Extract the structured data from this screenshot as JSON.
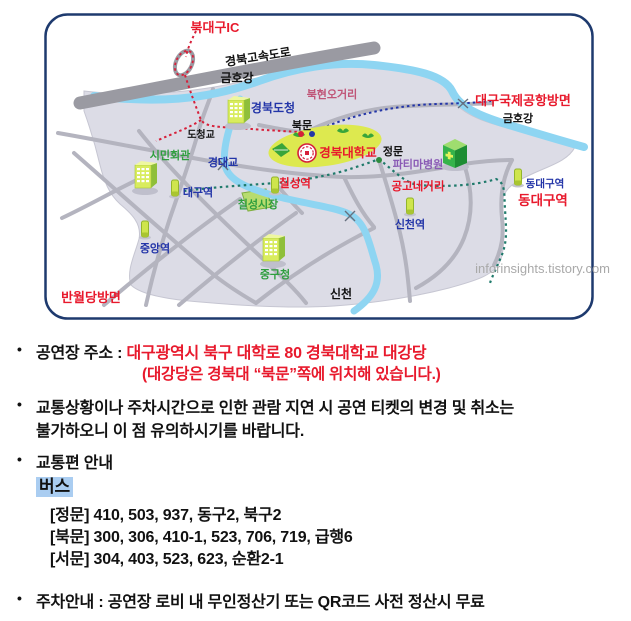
{
  "palette": {
    "red": "#e8192c",
    "navy": "#2335a8",
    "black": "#111111",
    "green": "#2e9e3e",
    "violet": "#8a5bb5",
    "rose": "#c05577",
    "gray_watermark": "#a9a9a9",
    "campus": "#dde94f",
    "river": "#8ed5f2",
    "land": "#dcdce6",
    "road": "#b4b4bf",
    "highway": "#9a9aa2",
    "subway_teal": "#1f7a6b",
    "bus_highlight": "#aacdf1",
    "map_border": "#1e3a6e"
  },
  "map": {
    "labels": [
      {
        "name": "bukdaegu-ic",
        "text": "북대구IC",
        "color": "#e8192c"
      },
      {
        "name": "gyeongbu-expressway",
        "text": "경북고속도로",
        "color": "#111111"
      },
      {
        "name": "geumhogang-west",
        "text": "금호강",
        "color": "#111111"
      },
      {
        "name": "gyeongbuk-docheong",
        "text": "경북도청",
        "color": "#2335a8"
      },
      {
        "name": "bukhyeon-ogeori",
        "text": "북현오거리",
        "color": "#c05577"
      },
      {
        "name": "airport-direction",
        "text": "대구국제공항방면",
        "color": "#e8192c"
      },
      {
        "name": "geumhogang-east",
        "text": "금호강",
        "color": "#111111"
      },
      {
        "name": "bukmun-gate",
        "text": "북문",
        "color": "#111111"
      },
      {
        "name": "docheonggyo-bridge",
        "text": "도청교",
        "color": "#111111"
      },
      {
        "name": "simin-hall",
        "text": "시민회관",
        "color": "#2e9e3e"
      },
      {
        "name": "gyeongdaegyo-bridge",
        "text": "경대교",
        "color": "#2335a8"
      },
      {
        "name": "knu-campus",
        "text": "경북대학교",
        "color": "#e8192c"
      },
      {
        "name": "jeongmun-gate",
        "text": "정문",
        "color": "#111111"
      },
      {
        "name": "fatima-hospital",
        "text": "파티마병원",
        "color": "#8a5bb5"
      },
      {
        "name": "gonggo-negeori",
        "text": "공고네거리",
        "color": "#e8192c"
      },
      {
        "name": "chilseong-station",
        "text": "칠성역",
        "color": "#e8192c"
      },
      {
        "name": "chilseong-market",
        "text": "칠성시장",
        "color": "#2e9e3e"
      },
      {
        "name": "daegu-station",
        "text": "대구역",
        "color": "#2335a8"
      },
      {
        "name": "jungang-station",
        "text": "중앙역",
        "color": "#2335a8"
      },
      {
        "name": "junggu-office",
        "text": "중구청",
        "color": "#2e9e3e"
      },
      {
        "name": "sincheon-station",
        "text": "신천역",
        "color": "#2335a8"
      },
      {
        "name": "dongdaegu-station-small",
        "text": "동대구역",
        "color": "#2335a8"
      },
      {
        "name": "dongdaegu-station-big",
        "text": "동대구역",
        "color": "#e8192c"
      },
      {
        "name": "banwoldang-direction",
        "text": "반월당방면",
        "color": "#e8192c"
      },
      {
        "name": "sincheon-river",
        "text": "신천",
        "color": "#111111"
      }
    ],
    "watermark": "inforinsights.tistory.com"
  },
  "info": {
    "bullet": "•",
    "address_label": "공연장 주소 : ",
    "address_value": "대구광역시 북구 대학로 80 경북대학교 대강당",
    "address_note": "(대강당은 경북대 “북문”쪽에 위치해 있습니다.)",
    "notice_line1": "교통상황이나 주차시간으로 인한 관람 지연 시 공연 티켓의 변경 및 취소는",
    "notice_line2": "불가하오니 이 점 유의하시기를 바랍니다.",
    "transport_title": "교통편 안내",
    "bus_label": "버스",
    "bus_routes": [
      "[정문] 410, 503, 937, 동구2, 북구2",
      "[북문] 300, 306, 410-1, 523, 706, 719, 급행6",
      "[서문] 304, 403, 523, 623, 순환2-1"
    ],
    "parking": "주차안내 : 공연장 로비 내 무인정산기 또는 QR코드 사전 정산시 무료"
  }
}
